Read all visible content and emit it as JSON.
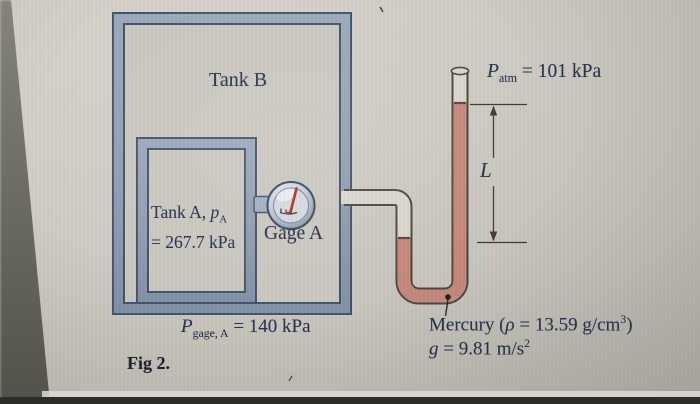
{
  "figure": {
    "caption": "Fig 2.",
    "tank_b": {
      "label": "Tank B"
    },
    "tank_a": {
      "prefix": "Tank A, ",
      "symbol": "p",
      "sub": "A",
      "line2": "= 267.7 kPa"
    },
    "gage_a": {
      "label": "Gage A"
    },
    "p_atm": {
      "symbol": "P",
      "sub": "atm",
      "rest": " = 101 kPa"
    },
    "p_gage": {
      "symbol": "P",
      "sub": "gage, A",
      "rest": " = 140 kPa"
    },
    "dimension": {
      "label": "L"
    },
    "mercury": {
      "name": "Mercury (",
      "rho": "ρ",
      "rest": " = 13.59 g/cm",
      "sup": "3",
      "close": ")"
    },
    "gravity": {
      "symbol": "g",
      "rest": " = 9.81 m/s",
      "sup": "2"
    },
    "colors": {
      "tank_wall": "#8e9cb0",
      "tank_outline": "#41526b",
      "paper": "#c9c6be",
      "tube_interior": "#d8d5cc",
      "tube_outline": "#4a463c",
      "mercury": "#c28779",
      "meniscus": "#5e4038",
      "needle_red": "#b5271e",
      "text_navy": "#26324e",
      "dimension_line": "#3a382f",
      "bottom_bar": "#2c2c28"
    }
  }
}
